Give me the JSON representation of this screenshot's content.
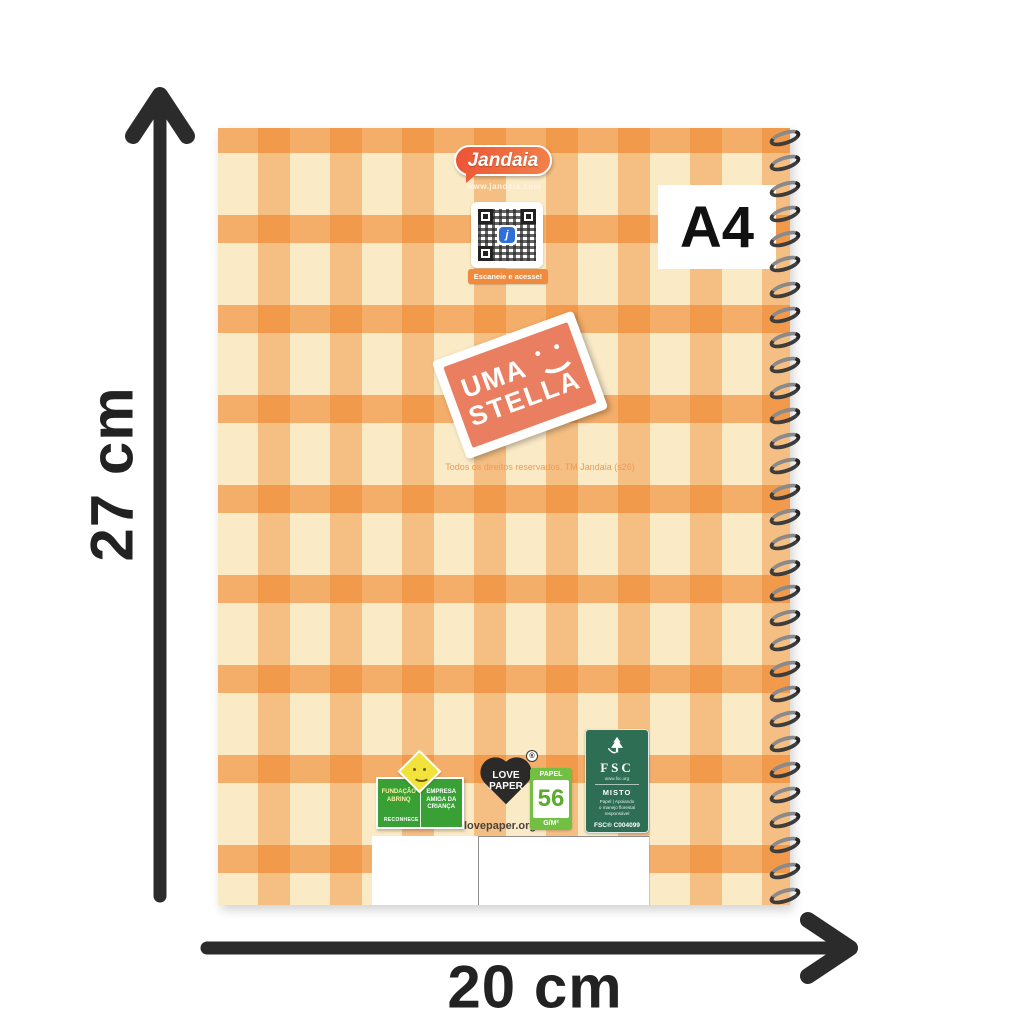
{
  "dimensions": {
    "height_label": "27 cm",
    "width_label": "20 cm",
    "arrow_color": "#2b2b2b"
  },
  "notebook": {
    "size_badge": "A4",
    "brand": {
      "name": "Jandaia",
      "website": "www.jandaia.com"
    },
    "qr": {
      "caption": "Escaneie e acesse!",
      "center_glyph": "j"
    },
    "stamp": {
      "word1": "UMA",
      "word2": "STELLA"
    },
    "copyright": "Todos os direitos reservados. TM Jandaia (s26)",
    "spiral": {
      "loop_count": 31
    },
    "badges": {
      "abrinq": {
        "col1_line1": "FUNDAÇÃO",
        "col1_line2": "ABRINQ",
        "footer": "RECONHECE",
        "col2_line1": "EMPRESA",
        "col2_line2": "AMIGA DA",
        "col2_line3": "CRIANÇA"
      },
      "love_paper": {
        "line1": "LOVE",
        "line2": "PAPER",
        "trademark": "®",
        "url": "lovepaper.org.br"
      },
      "paper_weight": {
        "label": "PAPEL",
        "value": "56",
        "unit": "G/M²"
      },
      "fsc": {
        "acronym": "FSC",
        "website": "www.fsc.org",
        "category": "MISTO",
        "desc_line1": "Papel | Apoiando",
        "desc_line2": "o manejo florestal",
        "desc_line3": "responsável",
        "license": "FSC® C004099"
      }
    },
    "colors": {
      "cover_base": "#faeac6",
      "stripe_orange": "#ee7c1e",
      "stamp_coral": "#e97e60",
      "brand_bubble": "#ee5f38",
      "fsc_green": "#2e6e55",
      "abrinq_green": "#39a036",
      "paper_green": "#72bf44"
    }
  }
}
